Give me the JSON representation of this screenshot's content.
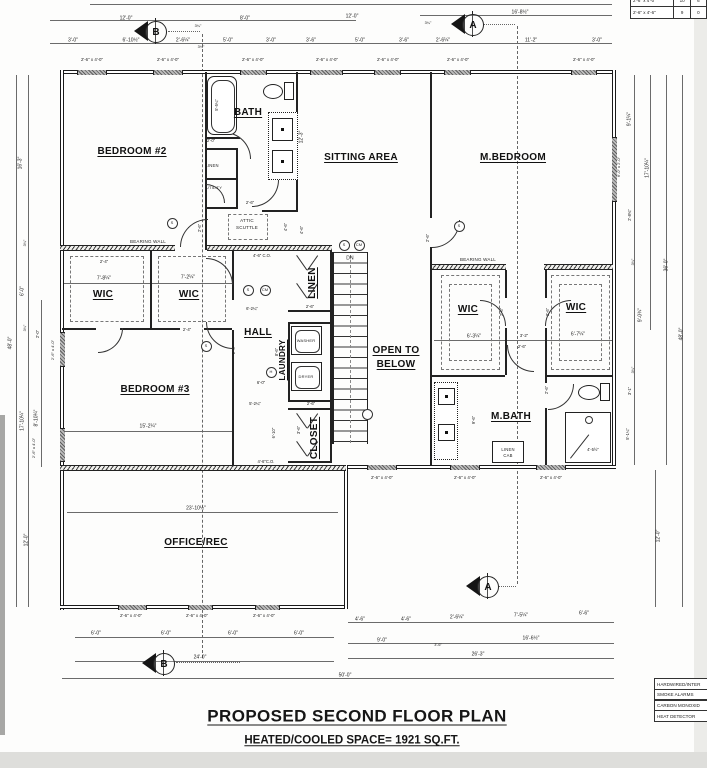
{
  "title": {
    "name": "PROPOSED SECOND FLOOR PLAN",
    "space": "HEATED/COOLED SPACE= 1921 SQ.FT."
  },
  "rooms": [
    {
      "t": "BEDROOM #2",
      "x": 132,
      "y": 152
    },
    {
      "t": "BATH",
      "x": 248,
      "y": 113
    },
    {
      "t": "SITTING AREA",
      "x": 361,
      "y": 158
    },
    {
      "t": "M.BEDROOM",
      "x": 513,
      "y": 158
    },
    {
      "t": "WIC",
      "x": 103,
      "y": 295
    },
    {
      "t": "WIC",
      "x": 189,
      "y": 295
    },
    {
      "t": "WIC",
      "x": 468,
      "y": 310
    },
    {
      "t": "WIC",
      "x": 576,
      "y": 308
    },
    {
      "t": "HALL",
      "x": 258,
      "y": 333
    },
    {
      "t": "LINEN",
      "x": 313,
      "y": 283,
      "r": -90
    },
    {
      "t": "LAUNDRY",
      "x": 283,
      "y": 360,
      "r": -90,
      "s": 8
    },
    {
      "t": "BEDROOM #3",
      "x": 155,
      "y": 390
    },
    {
      "t": "CLOSET",
      "x": 315,
      "y": 438,
      "r": -90
    },
    {
      "t": "OPEN TO",
      "x": 396,
      "y": 351
    },
    {
      "t": "BELOW",
      "x": 396,
      "y": 365
    },
    {
      "t": "M.BATH",
      "x": 511,
      "y": 417
    },
    {
      "t": "OFFICE/REC",
      "x": 196,
      "y": 543
    }
  ],
  "plan_labels": [
    {
      "t": "BEARING WALL",
      "x": 148,
      "y": 242
    },
    {
      "t": "BEARING WALL",
      "x": 478,
      "y": 260
    },
    {
      "t": "ATTIC",
      "x": 247,
      "y": 221
    },
    {
      "t": "SCUTTLE",
      "x": 247,
      "y": 228
    },
    {
      "t": "DN",
      "x": 350,
      "y": 259,
      "s": 5
    },
    {
      "t": "WASHER",
      "x": 306,
      "y": 341,
      "s": 4
    },
    {
      "t": "DRYER",
      "x": 306,
      "y": 377,
      "s": 4
    },
    {
      "t": "LINEN",
      "x": 212,
      "y": 166,
      "s": 4.2
    },
    {
      "t": "UTILITY",
      "x": 214,
      "y": 188,
      "s": 4
    },
    {
      "t": "LINEN",
      "x": 508,
      "y": 450,
      "s": 4.2
    },
    {
      "t": "CAB",
      "x": 508,
      "y": 456,
      "s": 4.2
    }
  ],
  "dims": [
    {
      "t": "12'-0\"",
      "x": 126,
      "y": 19
    },
    {
      "t": "8'-0\"",
      "x": 245,
      "y": 19
    },
    {
      "t": "12'-0\"",
      "x": 352,
      "y": 17
    },
    {
      "t": "16'-8½\"",
      "x": 520,
      "y": 13
    },
    {
      "t": "3'-0\"",
      "x": 73,
      "y": 41
    },
    {
      "t": "6'-10½\"",
      "x": 131,
      "y": 41
    },
    {
      "t": "2'-6¼\"",
      "x": 183,
      "y": 41
    },
    {
      "t": "5'-0\"",
      "x": 228,
      "y": 41
    },
    {
      "t": "3'-0\"",
      "x": 271,
      "y": 41
    },
    {
      "t": "3'-6\"",
      "x": 311,
      "y": 41
    },
    {
      "t": "5'-0\"",
      "x": 360,
      "y": 41
    },
    {
      "t": "3'-6\"",
      "x": 404,
      "y": 41
    },
    {
      "t": "2'-6¼\"",
      "x": 443,
      "y": 41
    },
    {
      "t": "11'-2\"",
      "x": 531,
      "y": 41
    },
    {
      "t": "3'-0\"",
      "x": 597,
      "y": 41
    },
    {
      "t": "3¼\"",
      "x": 198,
      "y": 27,
      "s": 3.8
    },
    {
      "t": "3¼\"",
      "x": 201,
      "y": 48,
      "s": 3.8
    },
    {
      "t": "3¼\"",
      "x": 428,
      "y": 24,
      "s": 3.8
    },
    {
      "t": "2'-6\" x 4'-0\"",
      "x": 92,
      "y": 60,
      "s": 4.4
    },
    {
      "t": "2'-6\" x 4'-0\"",
      "x": 168,
      "y": 60,
      "s": 4.4
    },
    {
      "t": "2'-6\" x 4'-0\"",
      "x": 253,
      "y": 60,
      "s": 4.4
    },
    {
      "t": "2'-6\" x 4'-0\"",
      "x": 327,
      "y": 60,
      "s": 4.4
    },
    {
      "t": "2'-6\" x 4'-0\"",
      "x": 388,
      "y": 60,
      "s": 4.4
    },
    {
      "t": "2'-6\" x 4'-0\"",
      "x": 458,
      "y": 60,
      "s": 4.4
    },
    {
      "t": "2'-6\" x 4'-0\"",
      "x": 584,
      "y": 60,
      "s": 4.4
    },
    {
      "t": "16'-3\"",
      "x": 21,
      "y": 163,
      "r": -90
    },
    {
      "t": "6'-0\"",
      "x": 23,
      "y": 291,
      "r": -90
    },
    {
      "t": "48'-0\"",
      "x": 11,
      "y": 343,
      "r": -90
    },
    {
      "t": "2'-0\"",
      "x": 38,
      "y": 334,
      "r": -90,
      "s": 4.2
    },
    {
      "t": "2'-6\" x 4'-0\"",
      "x": 53,
      "y": 350,
      "r": -90,
      "s": 4
    },
    {
      "t": "17'-10¼\"",
      "x": 23,
      "y": 421,
      "r": -90
    },
    {
      "t": "8'-10¼\"",
      "x": 37,
      "y": 418,
      "r": -90
    },
    {
      "t": "2'-6\" x 4'-0\"",
      "x": 34,
      "y": 448,
      "r": -90,
      "s": 4
    },
    {
      "t": "3¼\"",
      "x": 26,
      "y": 243,
      "r": -90,
      "s": 3.8
    },
    {
      "t": "3¼\"",
      "x": 26,
      "y": 328,
      "r": -90,
      "s": 3.8
    },
    {
      "t": "12'-0\"",
      "x": 27,
      "y": 540,
      "r": -90
    },
    {
      "t": "9'-1¼\"",
      "x": 630,
      "y": 119,
      "r": -90
    },
    {
      "t": "6'-0\" x 2'-0\"",
      "x": 619,
      "y": 167,
      "r": -90,
      "s": 4
    },
    {
      "t": "17'-10¼\"",
      "x": 648,
      "y": 168,
      "r": -90
    },
    {
      "t": "2'-8¾\"",
      "x": 630,
      "y": 215,
      "r": -90,
      "s": 4.2
    },
    {
      "t": "36'-0\"",
      "x": 667,
      "y": 265,
      "r": -90
    },
    {
      "t": "9'-0¾\"",
      "x": 641,
      "y": 315,
      "r": -90
    },
    {
      "t": "48'-0\"",
      "x": 682,
      "y": 334,
      "r": -90
    },
    {
      "t": "3'-1\"",
      "x": 630,
      "y": 391,
      "r": -90,
      "s": 4.2
    },
    {
      "t": "5'-1¼\"",
      "x": 628,
      "y": 434,
      "r": -90,
      "s": 4.2
    },
    {
      "t": "12'-0\"",
      "x": 659,
      "y": 536,
      "r": -90
    },
    {
      "t": "3¼\"",
      "x": 634,
      "y": 262,
      "r": -90,
      "s": 3.8
    },
    {
      "t": "3¼\"",
      "x": 634,
      "y": 370,
      "r": -90,
      "s": 3.8
    },
    {
      "t": "2'-6\" x 4'-0\"",
      "x": 382,
      "y": 478,
      "s": 4.4
    },
    {
      "t": "2'-6\" x 4'-0\"",
      "x": 465,
      "y": 478,
      "s": 4.4
    },
    {
      "t": "2'-6\" x 4'-0\"",
      "x": 551,
      "y": 478,
      "s": 4.4
    },
    {
      "t": "2'-6\" x 4'-0\"",
      "x": 131,
      "y": 616,
      "s": 4.4
    },
    {
      "t": "2'-6\" x 4'-0\"",
      "x": 197,
      "y": 616,
      "s": 4.4
    },
    {
      "t": "2'-6\" x 4'-0\"",
      "x": 264,
      "y": 616,
      "s": 4.4
    },
    {
      "t": "6'-0\"",
      "x": 96,
      "y": 634
    },
    {
      "t": "6'-0\"",
      "x": 166,
      "y": 634
    },
    {
      "t": "6'-0\"",
      "x": 233,
      "y": 634
    },
    {
      "t": "6'-0\"",
      "x": 299,
      "y": 634
    },
    {
      "t": "4'-6\"",
      "x": 360,
      "y": 620
    },
    {
      "t": "4'-6\"",
      "x": 406,
      "y": 620
    },
    {
      "t": "2'-6¼\"",
      "x": 457,
      "y": 618
    },
    {
      "t": "7'-5¼\"",
      "x": 521,
      "y": 616
    },
    {
      "t": "6'-6\"",
      "x": 584,
      "y": 614
    },
    {
      "t": "9'-0\"",
      "x": 382,
      "y": 641
    },
    {
      "t": "16'-6½\"",
      "x": 531,
      "y": 639
    },
    {
      "t": "3'-6\"",
      "x": 438,
      "y": 646,
      "s": 3.8
    },
    {
      "t": "24'-0\"",
      "x": 200,
      "y": 658
    },
    {
      "t": "26'-3\"",
      "x": 478,
      "y": 655
    },
    {
      "t": "50'-0\"",
      "x": 345,
      "y": 676
    },
    {
      "t": "5'-5¼\"",
      "x": 217,
      "y": 105,
      "r": -90,
      "s": 4.2
    },
    {
      "t": "2'-0\"",
      "x": 211,
      "y": 141,
      "s": 4.2
    },
    {
      "t": "2'-6\"",
      "x": 250,
      "y": 203,
      "s": 4.2
    },
    {
      "t": "12'-3\"",
      "x": 302,
      "y": 137,
      "r": -90
    },
    {
      "t": "4'-6\"",
      "x": 302,
      "y": 230,
      "r": -90,
      "s": 4.2
    },
    {
      "t": "4'-6\"",
      "x": 286,
      "y": 227,
      "r": -90,
      "s": 4.2
    },
    {
      "t": "2'-6\"",
      "x": 200,
      "y": 228,
      "r": -90,
      "s": 4.2
    },
    {
      "t": "4'-6\" C.O.",
      "x": 262,
      "y": 256,
      "s": 4.2
    },
    {
      "t": "2'-4\"",
      "x": 104,
      "y": 262,
      "s": 4.2
    },
    {
      "t": "7'-8¼\"",
      "x": 104,
      "y": 279
    },
    {
      "t": "7'-2¼\"",
      "x": 188,
      "y": 278
    },
    {
      "t": "2'-4\"",
      "x": 187,
      "y": 330,
      "s": 4.2
    },
    {
      "t": "6'-2¼\"",
      "x": 252,
      "y": 309,
      "s": 4.2
    },
    {
      "t": "2'-6\"",
      "x": 310,
      "y": 307,
      "s": 4.2
    },
    {
      "t": "8'-6\"",
      "x": 277,
      "y": 352,
      "r": -90,
      "s": 4.2
    },
    {
      "t": "6'-0\"",
      "x": 261,
      "y": 383,
      "s": 4.2
    },
    {
      "t": "15'-2¼\"",
      "x": 148,
      "y": 427
    },
    {
      "t": "5'-2¼\"",
      "x": 255,
      "y": 404,
      "s": 4.2
    },
    {
      "t": "6'-10\"",
      "x": 274,
      "y": 433,
      "r": -90,
      "s": 4.2
    },
    {
      "t": "3'-6\"",
      "x": 299,
      "y": 430,
      "r": -90,
      "s": 4.2
    },
    {
      "t": "2'-6\"",
      "x": 311,
      "y": 404,
      "s": 4.2
    },
    {
      "t": "4'-6\"C.O.",
      "x": 266,
      "y": 462,
      "s": 4.2
    },
    {
      "t": "2'-6\"",
      "x": 234,
      "y": 350,
      "r": -90,
      "s": 4.2
    },
    {
      "t": "23'-10½\"",
      "x": 196,
      "y": 509
    },
    {
      "t": "6'-3¼\"",
      "x": 474,
      "y": 337
    },
    {
      "t": "3'-2\"",
      "x": 524,
      "y": 336,
      "s": 4.2
    },
    {
      "t": "2'-6\"",
      "x": 522,
      "y": 347,
      "s": 4.2
    },
    {
      "t": "6'-7¼\"",
      "x": 578,
      "y": 335
    },
    {
      "t": "2'-6\"",
      "x": 502,
      "y": 312,
      "r": -90,
      "s": 4.2
    },
    {
      "t": "2'-6\"",
      "x": 548,
      "y": 312,
      "r": -90,
      "s": 4.2
    },
    {
      "t": "2'-6\"",
      "x": 547,
      "y": 390,
      "r": -90,
      "s": 4.2
    },
    {
      "t": "9'-6\"",
      "x": 474,
      "y": 420,
      "r": -90,
      "s": 4.2
    },
    {
      "t": "4'-5½\"",
      "x": 593,
      "y": 450,
      "s": 4.2
    },
    {
      "t": "2'-6\"",
      "x": 428,
      "y": 238,
      "r": -90,
      "s": 4.2
    }
  ],
  "symbols": [
    {
      "t": "S",
      "x": 171,
      "y": 222
    },
    {
      "t": "S",
      "x": 247,
      "y": 289
    },
    {
      "t": "CM",
      "x": 264,
      "y": 289
    },
    {
      "t": "H",
      "x": 270,
      "y": 371
    },
    {
      "t": "S",
      "x": 205,
      "y": 345
    },
    {
      "t": "S",
      "x": 343,
      "y": 244
    },
    {
      "t": "CM",
      "x": 358,
      "y": 244
    },
    {
      "t": "S",
      "x": 458,
      "y": 225
    }
  ],
  "markers": [
    {
      "t": "B",
      "x": 155,
      "y": 31
    },
    {
      "t": "A",
      "x": 472,
      "y": 24
    },
    {
      "t": "A",
      "x": 487,
      "y": 586
    },
    {
      "t": "B",
      "x": 163,
      "y": 663
    }
  ],
  "schedule": {
    "rows": [
      [
        "2'-6\" x 4'-0\"",
        "10",
        "6"
      ],
      [
        "2'-6\" x 4'-6\"",
        "9",
        "0"
      ]
    ]
  },
  "legend": {
    "rows": [
      "HARDWIRED/INTER",
      "SMOKE ALARMS",
      "CARBON MONOXID",
      "HEAT DETECTOR"
    ]
  }
}
